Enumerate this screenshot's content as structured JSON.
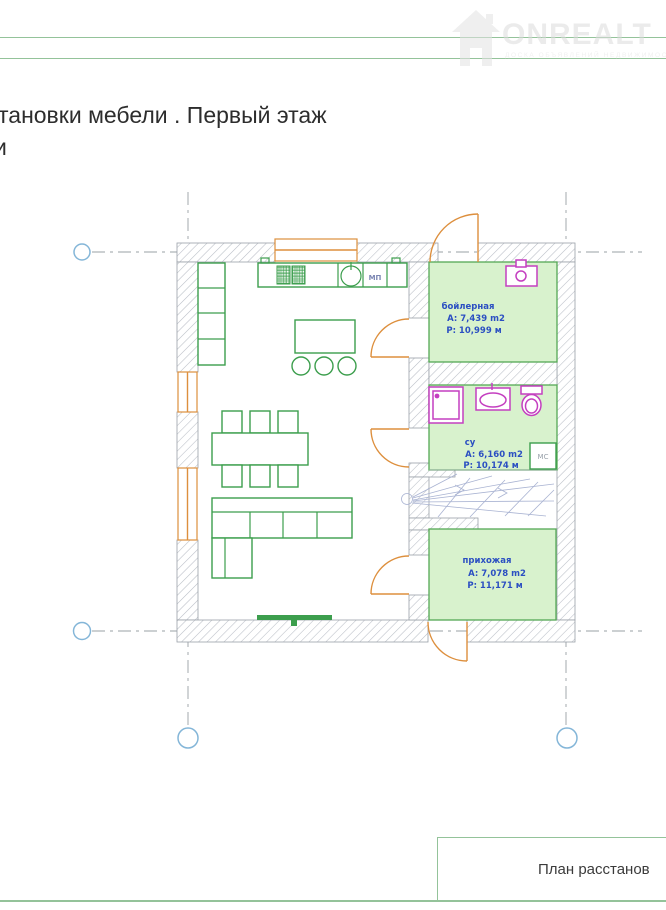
{
  "header": {
    "title_line1": "тановки мебели . Первый этаж",
    "title_line2": "и"
  },
  "watermark": {
    "brand": "ONREALT",
    "subtitle": "ДОСКА ОБЪЯВЛЕНИЙ НЕДВИЖИМОСТИ"
  },
  "plan": {
    "rooms": [
      {
        "name": "бойлерная",
        "area": "A: 7,439 m2",
        "perimeter": "P: 10,999 м"
      },
      {
        "name": "су",
        "area": "A: 6,160 m2",
        "perimeter": "P: 10,174 м"
      },
      {
        "name": "прихожая",
        "area": "A: 7,078 m2",
        "perimeter": "P: 11,171 м"
      }
    ],
    "labels": {
      "mp": "МП",
      "ms": "МС"
    }
  },
  "footer": {
    "title_block_label": "План расстанов"
  },
  "colors": {
    "furniture-green": "#3c9e4d",
    "room-fill": "#d8f2cd",
    "room-stroke": "#55a855",
    "label-blue": "#2b4fc2",
    "fixture-magenta": "#c43fc0",
    "door-orange": "#dd8f3d",
    "axis-blue": "#84b6d8",
    "stair-blue": "#a9b3d2",
    "frame-green": "#94c39a",
    "wall-hatch": "#b9bec6"
  }
}
